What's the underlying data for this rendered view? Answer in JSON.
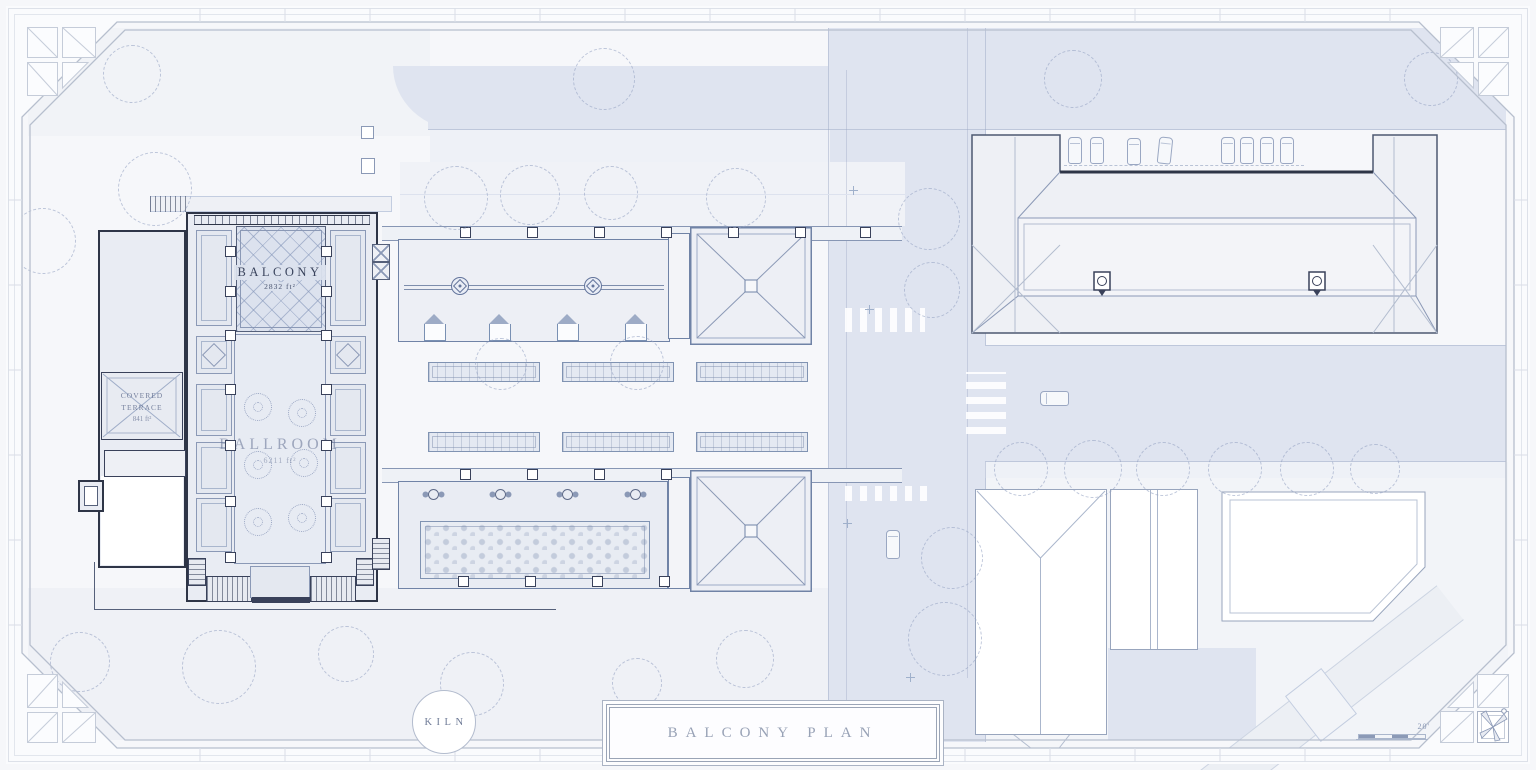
{
  "palette": {
    "paper": "#fafbfd",
    "ground": "#f6f7fa",
    "lawn": "#eff1f6",
    "road": "#dfe4f0",
    "building-fill": "#edeff5",
    "building-light": "#e9ecf3",
    "wall-dark": "#2e3547",
    "line": "#7d8dac",
    "line-strong": "#4d5871",
    "tree": "#c5cfe2",
    "text-dark": "#39435c",
    "text-soft": "#98a2b6"
  },
  "plan": {
    "rooms": {
      "balcony": {
        "name": "BALCONY",
        "area": "2832 ft²"
      },
      "ballroom": {
        "name": "BALLROOM",
        "area": "6211 ft²"
      },
      "covered_terrace": {
        "name": "COVERED TERRACE",
        "area": "841 ft²"
      }
    }
  },
  "title_block": {
    "title": "BALCONY PLAN"
  },
  "logo": {
    "label": "KILN"
  },
  "scale_bar": {
    "label": "20'"
  },
  "icons": {
    "north_arrow": "compass-north-arrow",
    "tree": "tree-canopy-circle",
    "car": "car-plan-symbol",
    "lamp": "street-lamp-symbol",
    "finial": "roof-finial-symbol",
    "chimney": "chimney-symbol"
  }
}
